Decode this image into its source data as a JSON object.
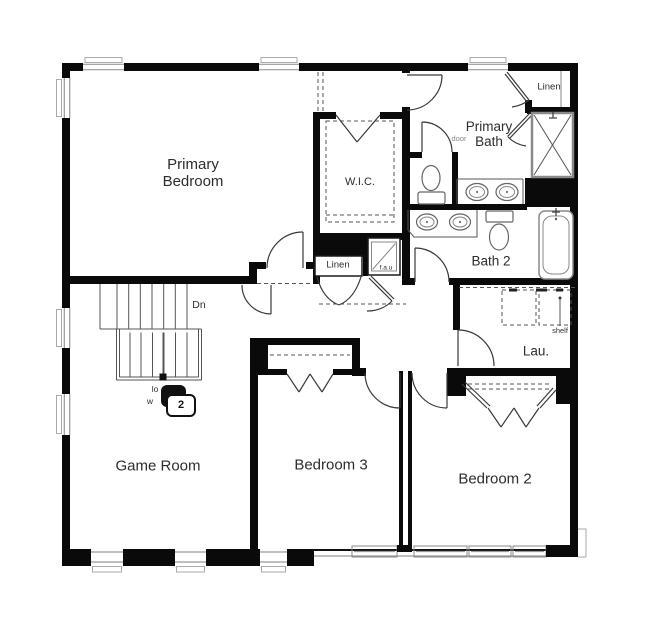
{
  "plan": {
    "rooms": {
      "primary_bedroom": {
        "line1": "Primary",
        "line2": "Bedroom"
      },
      "wic": "W.I.C.",
      "primary_bath": {
        "line1": "Primary",
        "line2": "Bath"
      },
      "bath2": "Bath 2",
      "laundry": "Lau.",
      "game_room": "Game Room",
      "bedroom3": "Bedroom 3",
      "bedroom2": "Bedroom 2"
    },
    "closets": {
      "linen_top": "Linen",
      "linen_hall": "Linen",
      "fau": "f.a.u"
    },
    "annotations": {
      "stairs_down": "Dn",
      "door": "door",
      "shelf": "shelf",
      "low_wall_line1": "lo",
      "low_wall_line2": "w",
      "keynote_number": "2"
    },
    "colors": {
      "wall": "#0a0a0a",
      "line": "#444444",
      "window": "#999999",
      "background": "#ffffff"
    }
  }
}
